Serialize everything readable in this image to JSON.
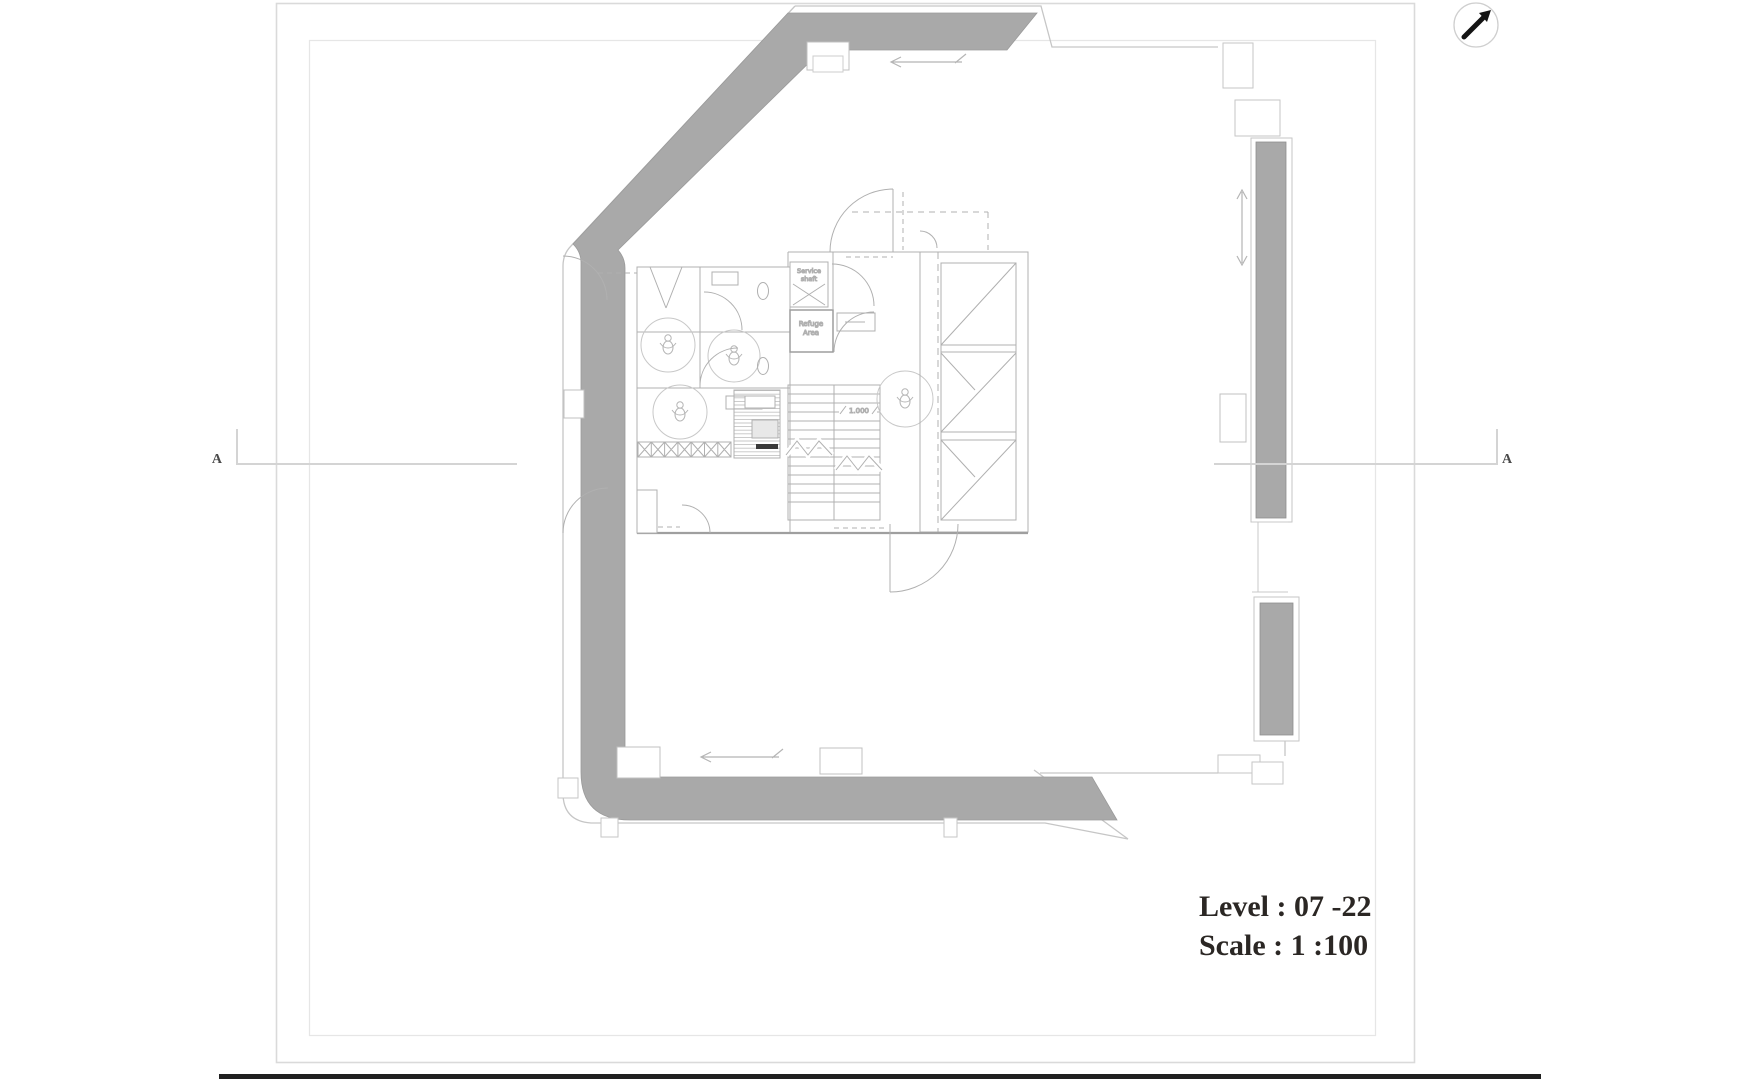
{
  "sheet": {
    "level_label": "Level : 07 -22",
    "scale_label": "Scale : 1 :100"
  },
  "section_markers": {
    "left": "A",
    "right": "A"
  },
  "core_labels": {
    "service_shaft": [
      "Service",
      "shaft"
    ],
    "refuge_area": [
      "Refuge",
      "Area"
    ],
    "stair_level": "1.000"
  },
  "icons": {
    "north_arrow": "north-arrow-icon"
  },
  "colors": {
    "paper": "#ffffff",
    "wall_fill": "#a9a9a9",
    "wall_edge": "#979797",
    "outline": "#c6c6c6",
    "linework": "#b3b3b3",
    "text_dark": "#2b2724",
    "rule_black": "#202020"
  }
}
